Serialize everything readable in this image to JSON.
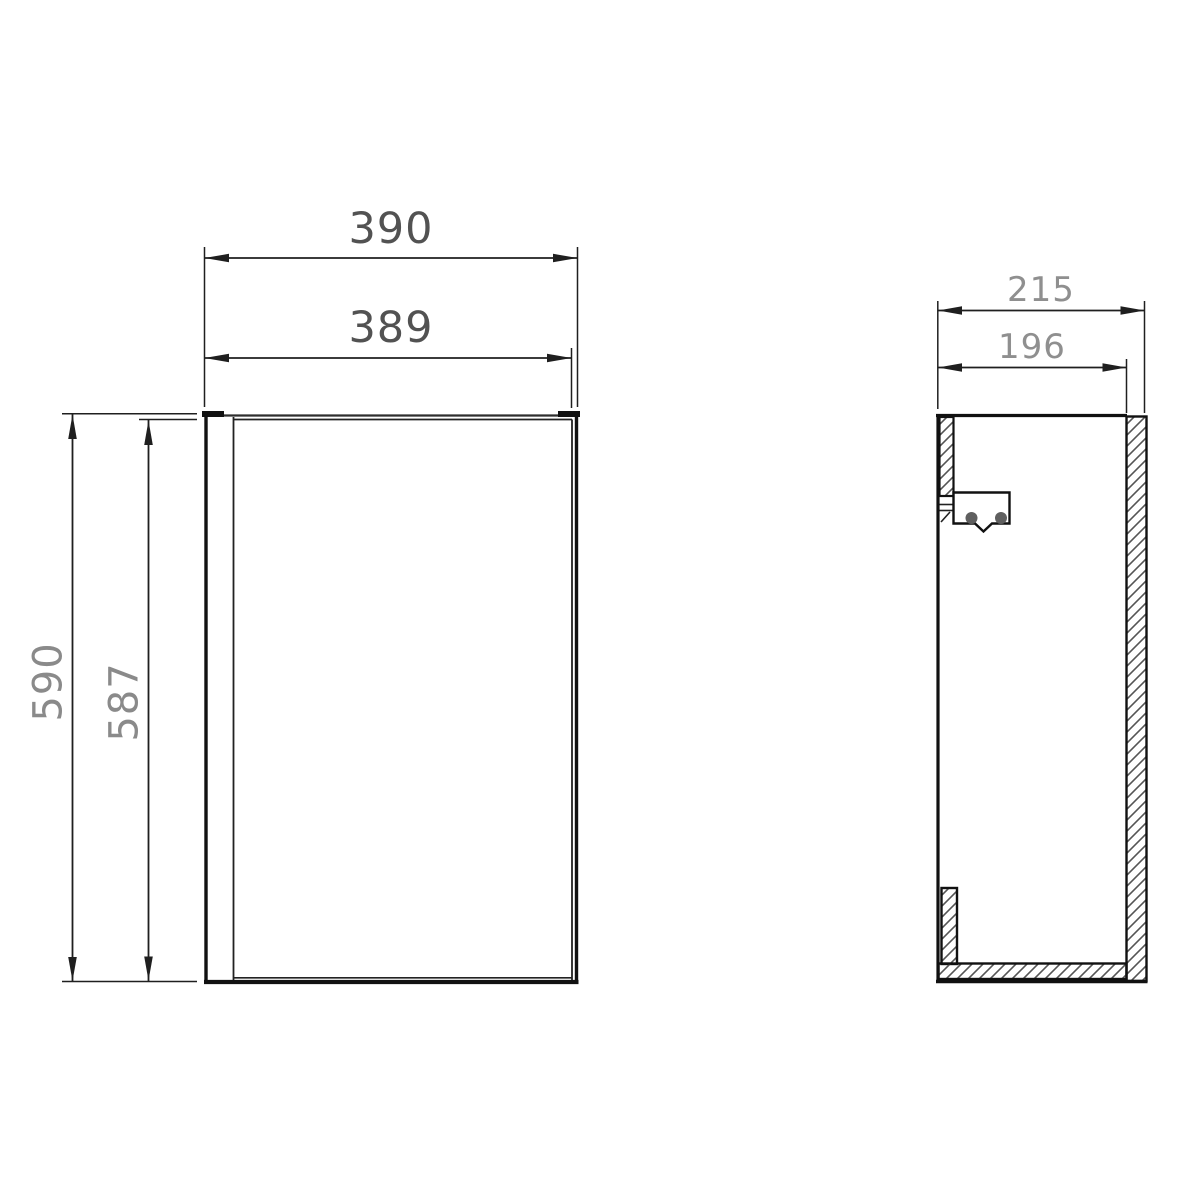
{
  "drawing": {
    "front_view": {
      "width_outer": "390",
      "width_inner": "389",
      "height_outer": "590",
      "height_inner": "587"
    },
    "side_view": {
      "depth_outer": "215",
      "depth_inner": "196"
    },
    "colors": {
      "background": "#ffffff",
      "outline": "#111111",
      "dim_line": "#1f1f1f",
      "hatch": "#555555",
      "dim_text_large": "#525252",
      "dim_text_mid": "#8a8a8a",
      "dim_text_small": "#8f8f8f"
    }
  }
}
